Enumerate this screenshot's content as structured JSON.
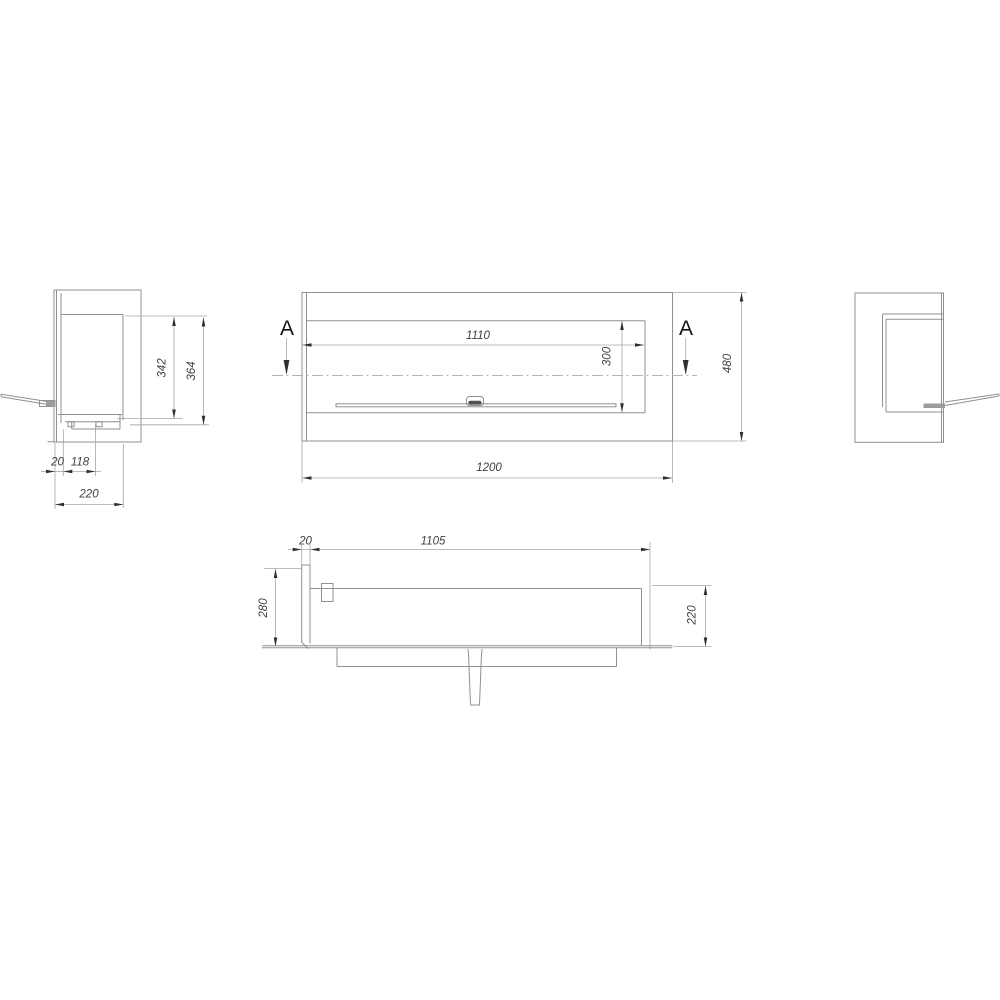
{
  "colors": {
    "background": "#ffffff",
    "drawing_line": "#909090",
    "dimension_line": "#a6a6a6",
    "centerline": "#b4b4b4",
    "arrow": "#2f2f2f",
    "dimension_text": "#3f3f3f",
    "section_text": "#141414",
    "knob": "#4f4f4f"
  },
  "drawing": {
    "section_label": "A",
    "front_view": {
      "opening_width": "1110",
      "opening_height": "300",
      "overall_width": "1200",
      "overall_height": "480"
    },
    "left_side_view": {
      "inner_height": "342",
      "outer_height": "364",
      "wall_thickness": "20",
      "inset": "118",
      "depth": "220"
    },
    "bottom_view": {
      "wall_thickness": "20",
      "inner_width": "1105",
      "outer_depth": "280",
      "inner_depth": "220"
    }
  }
}
